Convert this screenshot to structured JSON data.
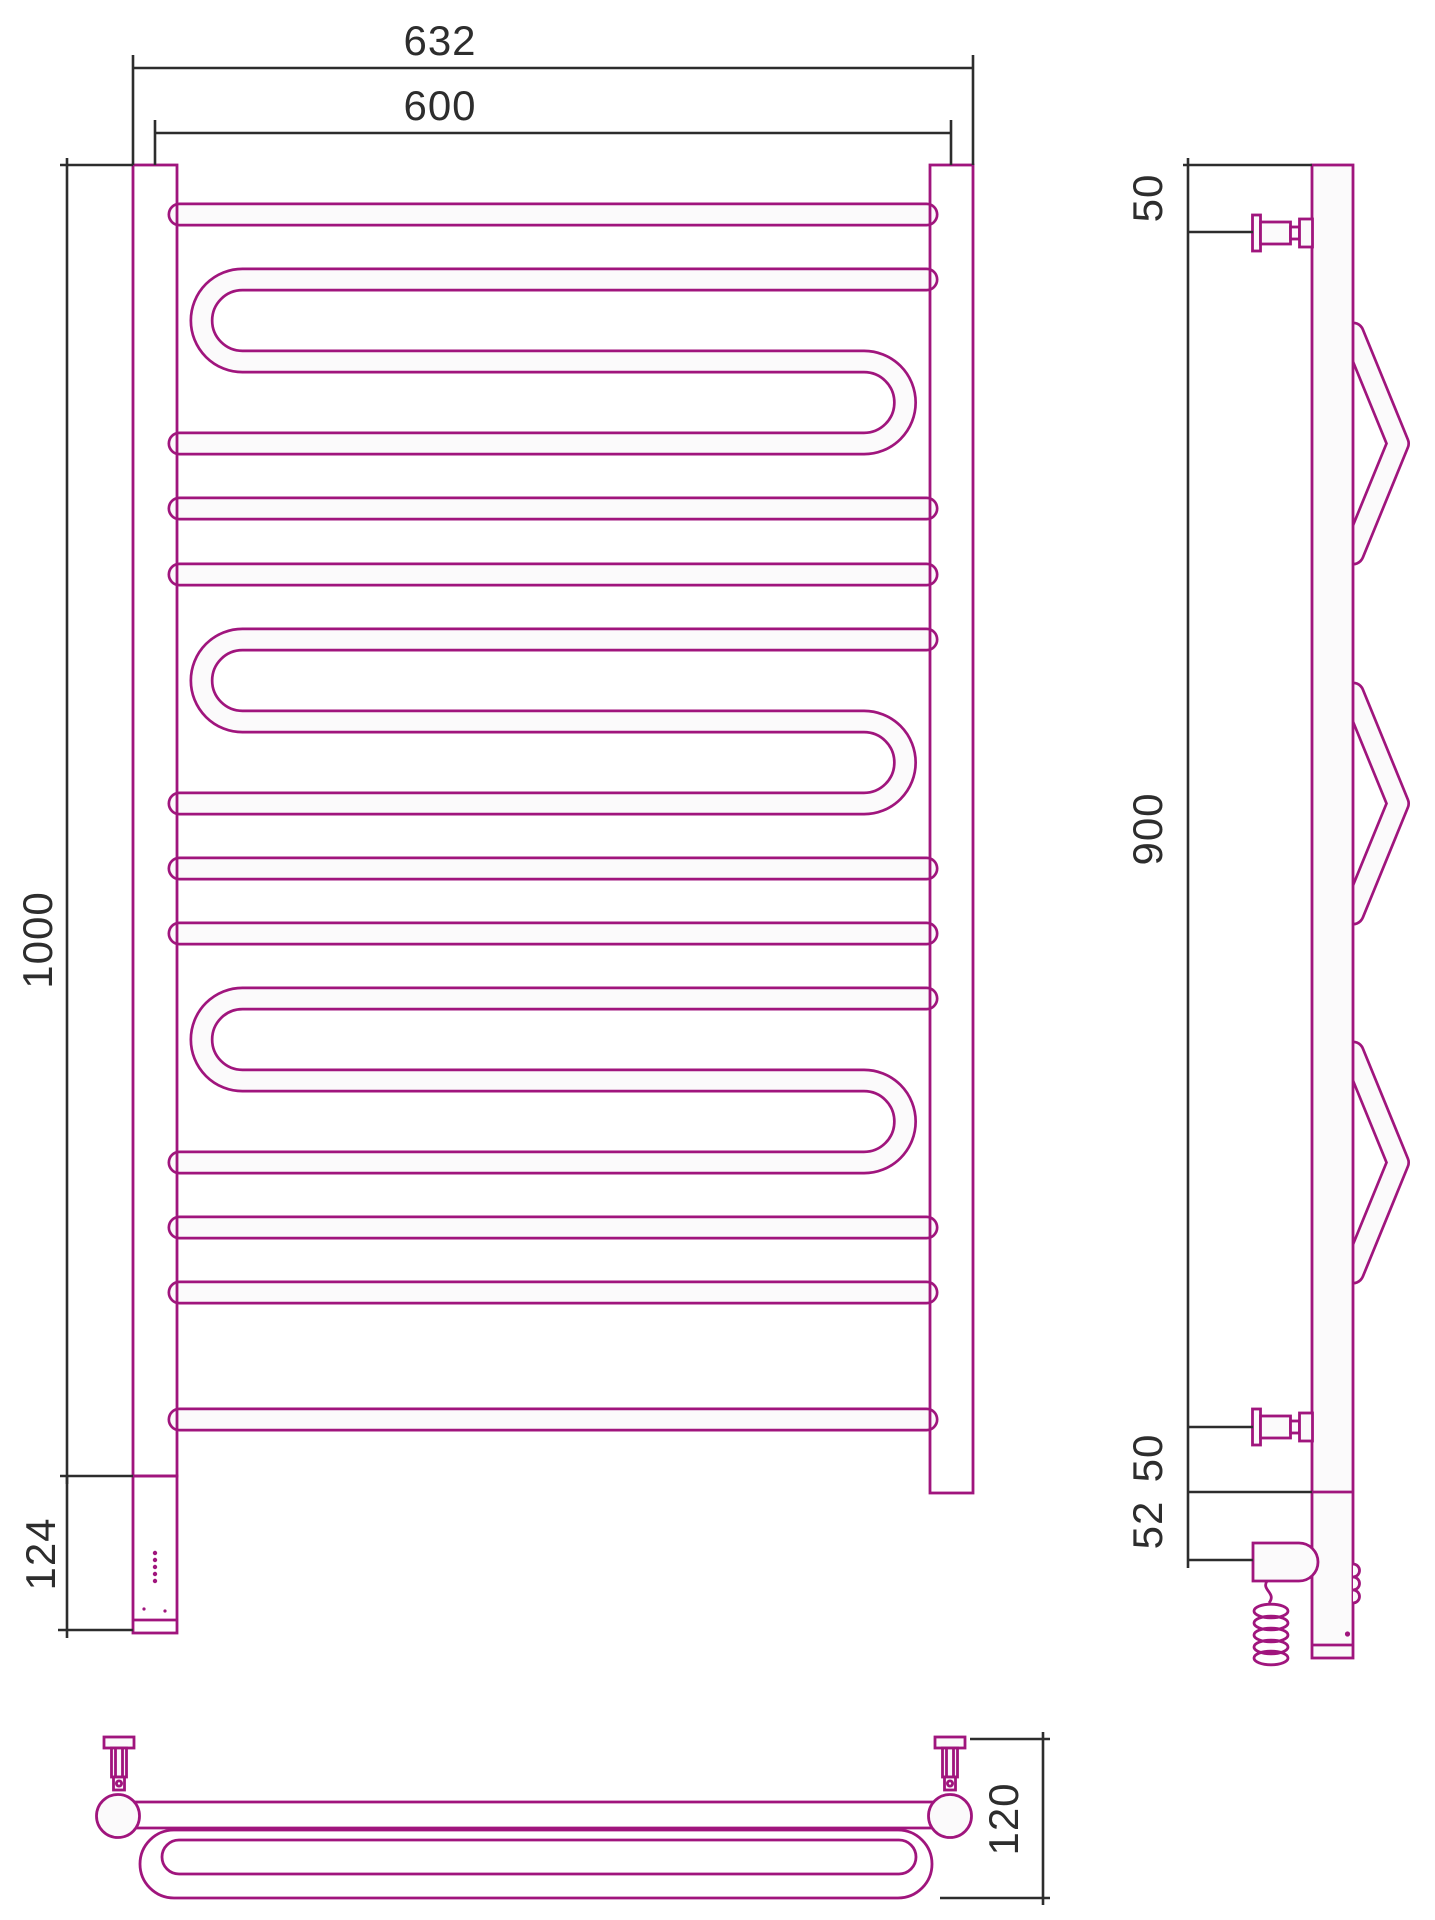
{
  "drawing_type": "towel-rail-technical-drawing",
  "colors": {
    "pipe": "#a0157d",
    "tubefill": "#fbfafb",
    "dim": "#2d2d2d",
    "bg": "#ffffff"
  },
  "dimensions": {
    "front": {
      "outer_width": "632",
      "center_width": "600",
      "height": "1000",
      "housing_height": "124"
    },
    "side": {
      "top_bracket_offset": "50",
      "bracket_span": "900",
      "bottom_bracket_offset": "50",
      "element_offset": "52"
    },
    "bottom": {
      "depth": "120"
    }
  }
}
